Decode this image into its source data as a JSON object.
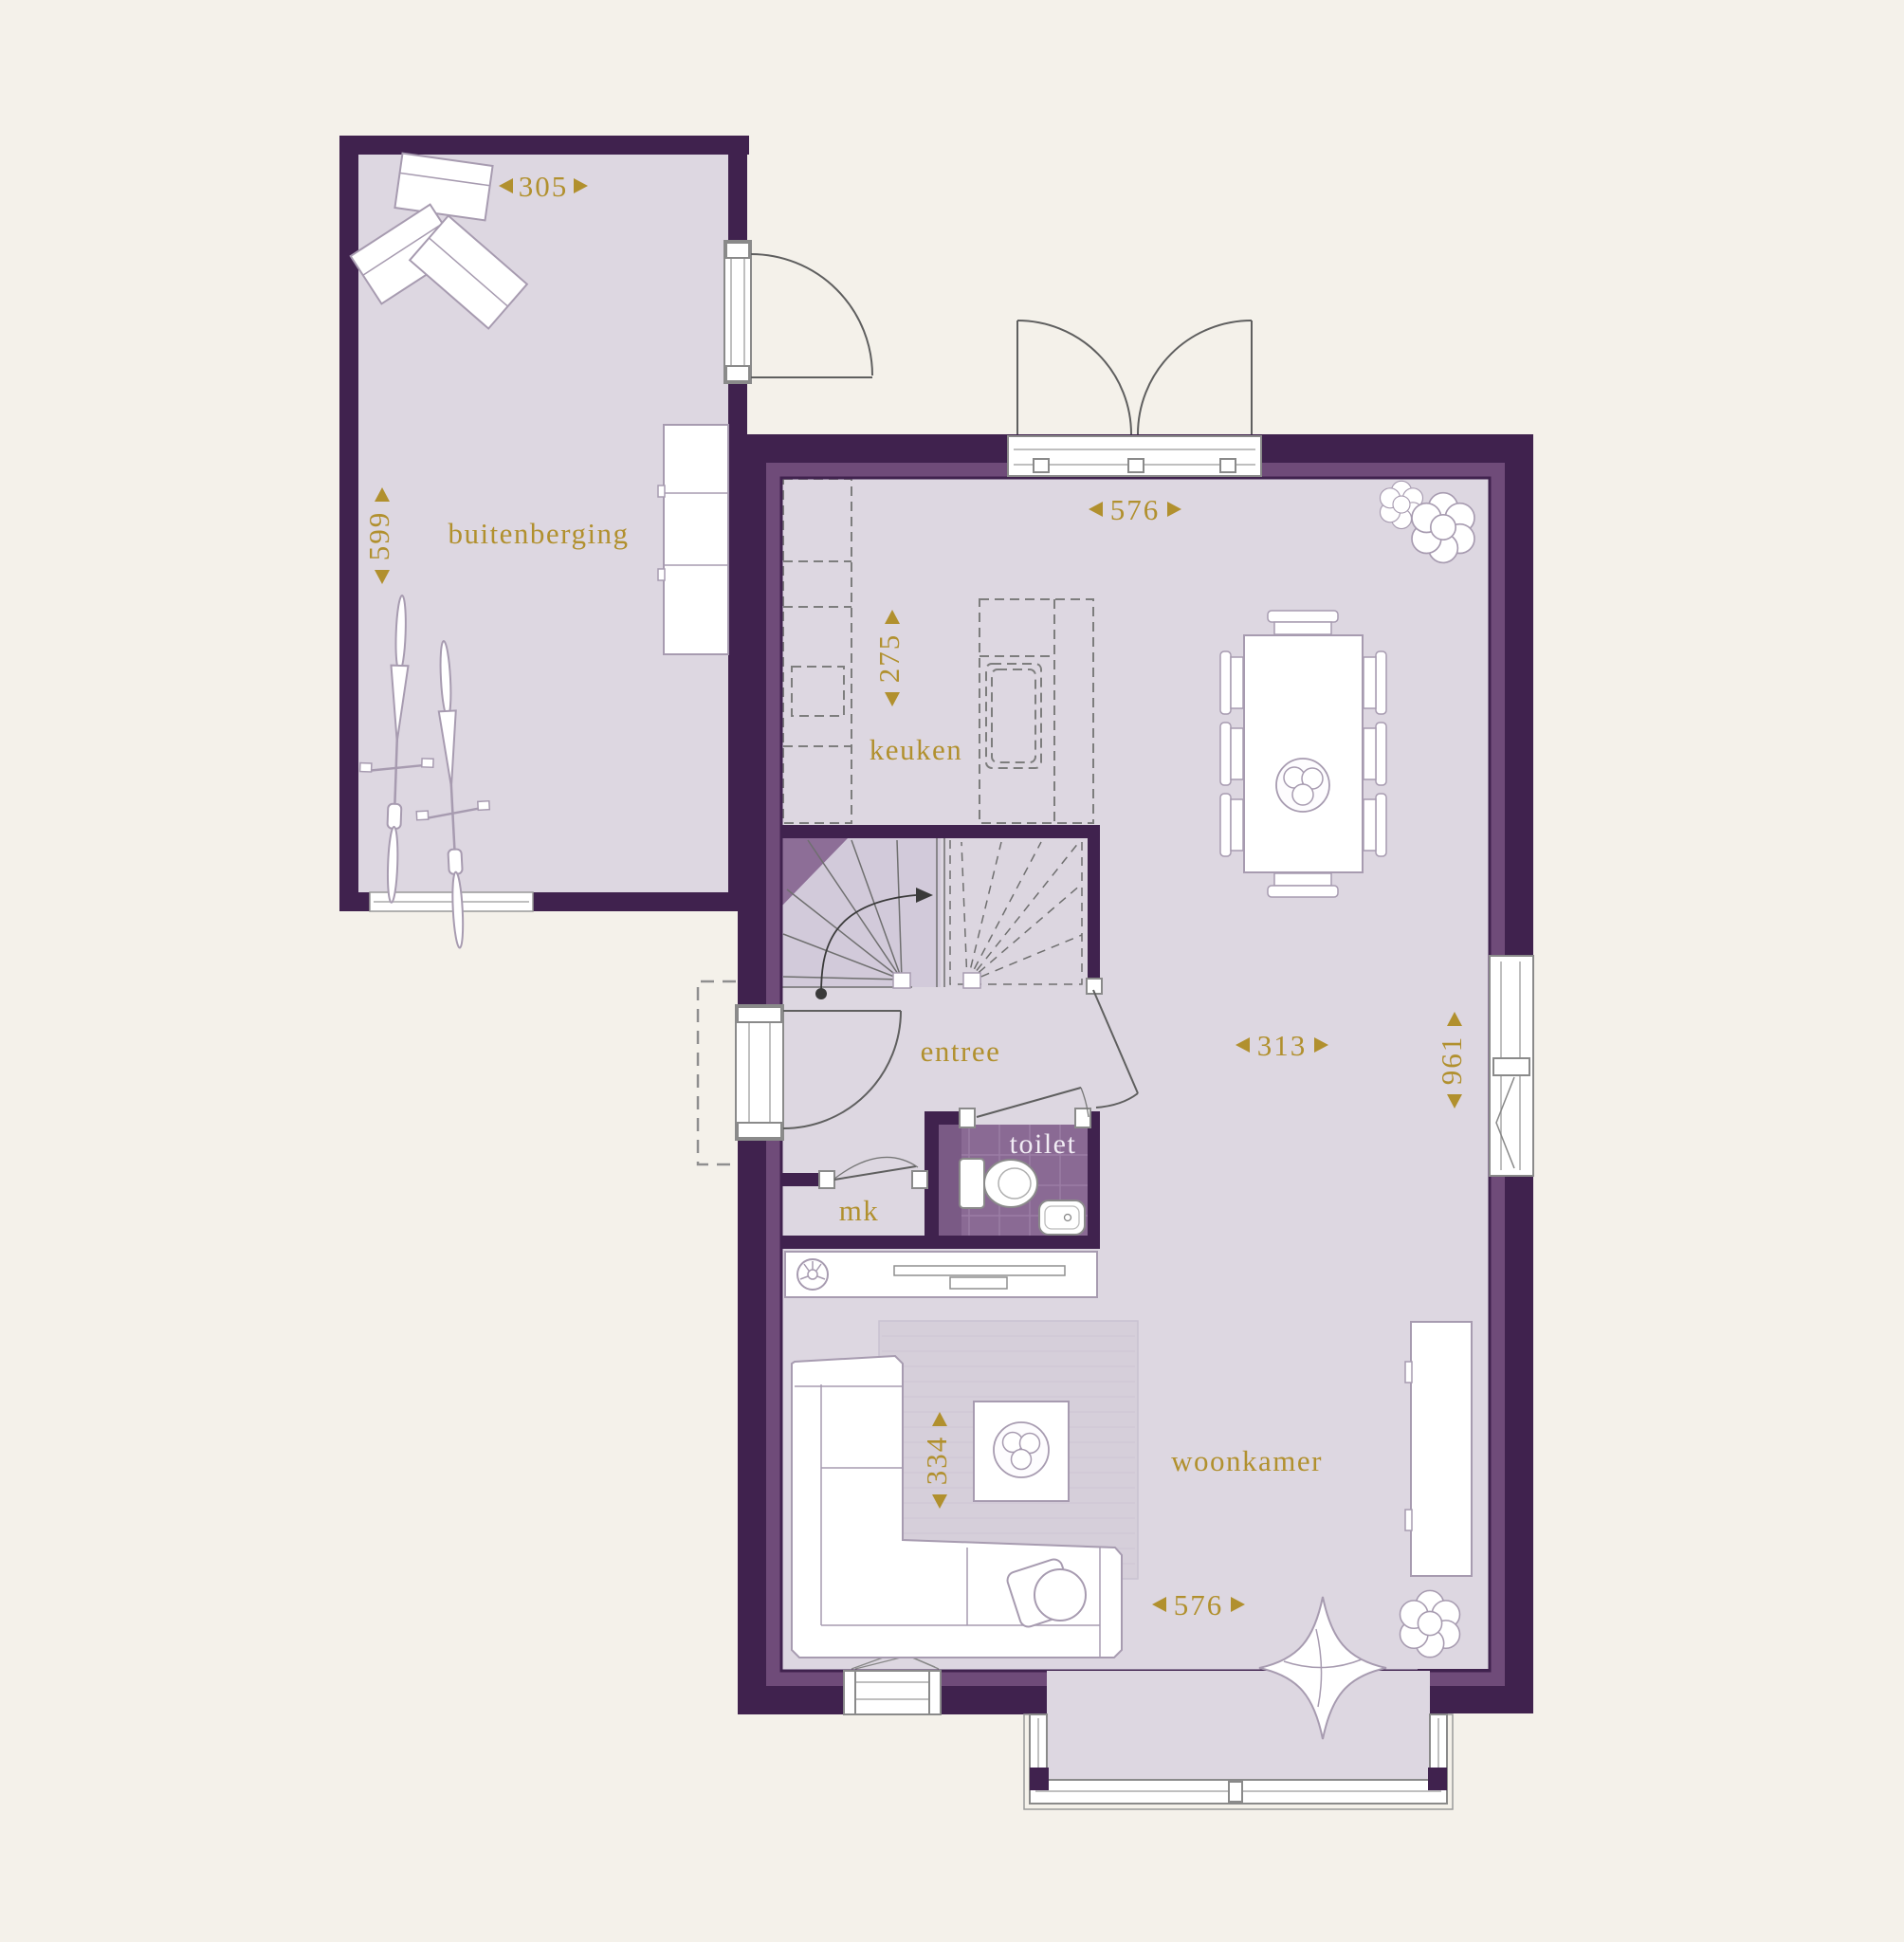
{
  "rooms": {
    "buitenberging": {
      "label": "buitenberging"
    },
    "keuken": {
      "label": "keuken"
    },
    "entree": {
      "label": "entree"
    },
    "toilet": {
      "label": "toilet"
    },
    "mk": {
      "label": "mk"
    },
    "woonkamer": {
      "label": "woonkamer"
    }
  },
  "dimensions": {
    "buitenberging_width": "305",
    "buitenberging_depth": "599",
    "keuken_width": "576",
    "keuken_depth": "275",
    "woonkamer_width": "313",
    "woonkamer_depth": "961",
    "zithoek_depth": "334",
    "woonkamer_width_south": "576"
  },
  "colors": {
    "background": "#f4f1ea",
    "wall": "#40224e",
    "wall_accent": "#6f4b79",
    "floor": "#ddd7e1",
    "kitchen_unit": "#d9d0de",
    "toilet_floor": "#8a6a94",
    "stair_fill": "#d2cada",
    "stair_corner": "#8d6e97",
    "rug": "#d6cfda",
    "dimension_text": "#b1902e",
    "furniture_outline": "#a79bb0"
  }
}
